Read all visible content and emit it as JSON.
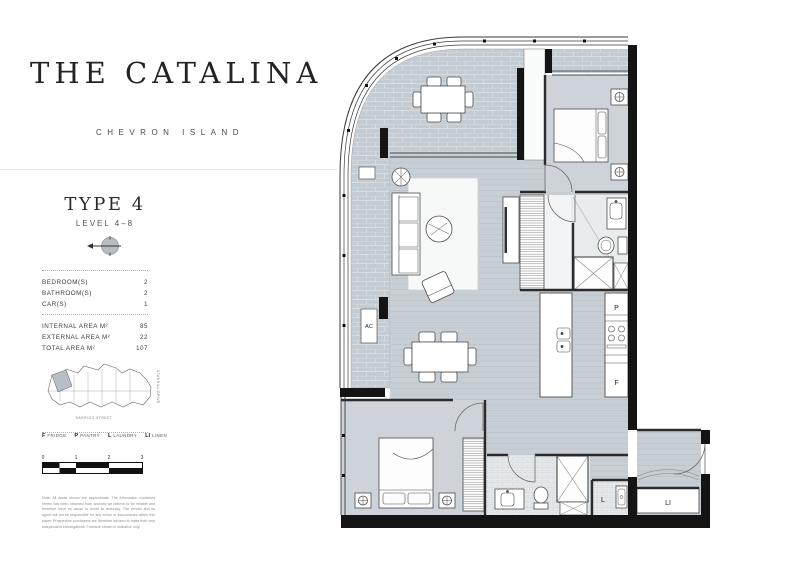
{
  "brand": {
    "title": "THE CATALINA",
    "subtitle": "CHEVRON ISLAND"
  },
  "unit": {
    "type": "TYPE 4",
    "level": "LEVEL 4–8"
  },
  "specs": {
    "rooms": [
      {
        "label": "BEDROOM(S)",
        "value": "2"
      },
      {
        "label": "BATHROOM(S)",
        "value": "2"
      },
      {
        "label": "CAR(S)",
        "value": "1"
      }
    ],
    "areas": [
      {
        "label": "INTERNAL AREA M²",
        "value": "85"
      },
      {
        "label": "EXTERNAL AREA M²",
        "value": "22"
      },
      {
        "label": "TOTAL AREA M²",
        "value": "107"
      }
    ]
  },
  "sitemap": {
    "street_right": "STANHILL DRIVE",
    "street_bottom": "DARRIGO STREET"
  },
  "legend": {
    "items": [
      {
        "symbol": "F",
        "label": "FRIDGE"
      },
      {
        "symbol": "P",
        "label": "PANTRY"
      },
      {
        "symbol": "L",
        "label": "LAUNDRY"
      },
      {
        "symbol": "LI",
        "label": "LINEN"
      }
    ]
  },
  "scalebar": {
    "ticks": [
      "0",
      "1",
      "2",
      "3"
    ]
  },
  "plan": {
    "labels": {
      "ac": "AC",
      "pantry": "P",
      "fridge": "F",
      "laundry": "L",
      "linen": "LI"
    }
  },
  "disclaimer": "Note: All areas shown are approximate. The information contained herein has been obtained from sources we believe to be reliable and therefore have no cause to doubt its accuracy. The vendor and its agent will not be responsible for any errors or inaccuracies within this paper. Prospective purchasers are therefore advised to make their own independent investigations. Furniture shown is indicative only."
}
